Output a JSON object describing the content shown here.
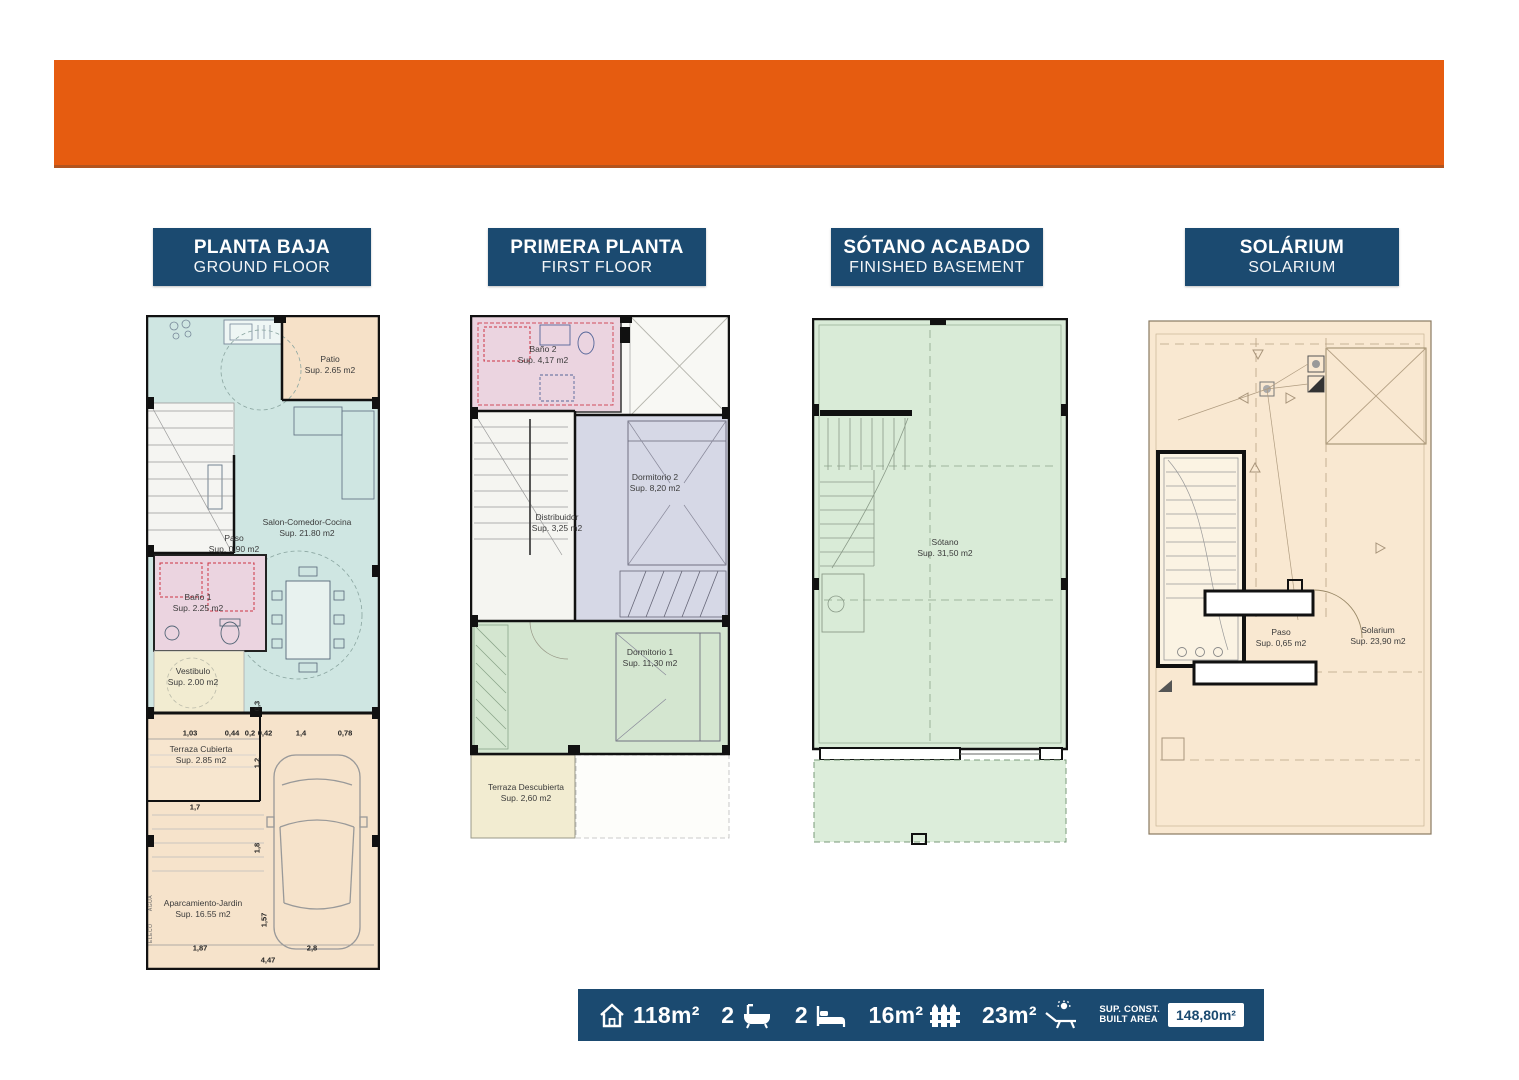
{
  "banner": {
    "color": "#E65C10"
  },
  "colors": {
    "accent_orange": "#E65C10",
    "navy": "#1B4A70"
  },
  "headers": [
    {
      "title": "PLANTA BAJA",
      "subtitle": "GROUND FLOOR"
    },
    {
      "title": "PRIMERA PLANTA",
      "subtitle": "FIRST FLOOR"
    },
    {
      "title": "SÓTANO ACABADO",
      "subtitle": "FINISHED BASEMENT"
    },
    {
      "title": "SOLÁRIUM",
      "subtitle": "SOLARIUM"
    }
  ],
  "plans": {
    "ground": {
      "rooms": {
        "patio": {
          "name": "Patio",
          "area": "Sup. 2.65 m2"
        },
        "salon": {
          "name": "Salon-Comedor-Cocina",
          "area": "Sup. 21.80 m2"
        },
        "paso": {
          "name": "Paso",
          "area": "Sup. 0.90 m2"
        },
        "bano1": {
          "name": "Baño 1",
          "area": "Sup. 2.25 m2"
        },
        "vestibulo": {
          "name": "Vestibulo",
          "area": "Sup. 2.00 m2"
        },
        "terraza_cubierta": {
          "name": "Terraza Cubierta",
          "area": "Sup. 2.85 m2"
        },
        "aparcamiento": {
          "name": "Aparcamiento-Jardin",
          "area": "Sup. 16.55 m2"
        }
      },
      "dims": [
        "1,03",
        "0,44",
        "0,2",
        "0,42",
        "1,4",
        "0,78"
      ],
      "dims2": {
        "d03": "0,3",
        "d12": "1,2",
        "d17": "1,7",
        "d18": "1,8",
        "d157": "1,57",
        "d187": "1,87",
        "d28": "2,8",
        "d447": "4,47"
      },
      "side_labels": [
        "AGUA",
        "TELECO"
      ]
    },
    "first": {
      "rooms": {
        "bano2": {
          "name": "Baño 2",
          "area": "Sup. 4,17 m2"
        },
        "distribuidor": {
          "name": "Distribuidor",
          "area": "Sup. 3,25 m2"
        },
        "dorm2": {
          "name": "Dormitorio 2",
          "area": "Sup. 8,20 m2"
        },
        "dorm1": {
          "name": "Dormitorio 1",
          "area": "Sup. 11,30 m2"
        },
        "terraza": {
          "name": "Terraza Descubierta",
          "area": "Sup. 2,60 m2"
        }
      }
    },
    "basement": {
      "rooms": {
        "sotano": {
          "name": "Sótano",
          "area": "Sup. 31,50 m2"
        }
      }
    },
    "solarium": {
      "rooms": {
        "paso": {
          "name": "Paso",
          "area": "Sup. 0,65 m2"
        },
        "solarium": {
          "name": "Solarium",
          "area": "Sup. 23,90 m2"
        }
      }
    }
  },
  "footer": {
    "house_area": "118m²",
    "baths": "2",
    "beds": "2",
    "terrace_area": "16m²",
    "solarium_area": "23m²",
    "built_label_line1": "SUP. CONST.",
    "built_label_line2": "BUILT AREA",
    "built_value": "148,80m²"
  }
}
